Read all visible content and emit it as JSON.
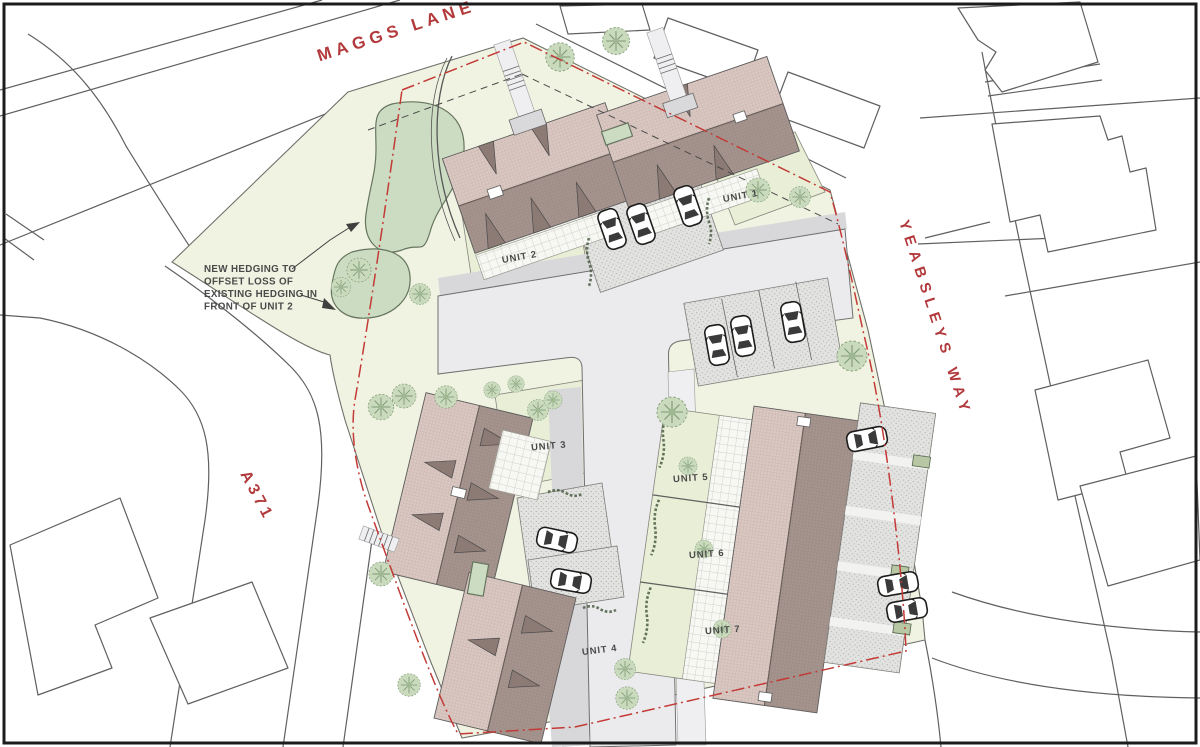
{
  "streets": {
    "maggs_lane": "MAGGS LANE",
    "yeabsleys_way": "YEABSLEYS WAY",
    "a371": "A371"
  },
  "units": [
    {
      "label": "UNIT 1"
    },
    {
      "label": "UNIT 2"
    },
    {
      "label": "UNIT 3"
    },
    {
      "label": "UNIT 4"
    },
    {
      "label": "UNIT 5"
    },
    {
      "label": "UNIT 6"
    },
    {
      "label": "UNIT 7"
    }
  ],
  "annotation": {
    "lines": [
      "NEW HEDGING TO",
      "OFFSET LOSS OF",
      "EXISTING HEDGING IN",
      "FRONT OF UNIT 2"
    ],
    "text": "NEW HEDGING TO OFFSET LOSS OF EXISTING HEDGING IN FRONT OF UNIT 2"
  },
  "colors": {
    "boundary-red": "#c33a36",
    "street-label-red": "#b23a3c",
    "site-green": "#f1f3e2",
    "garden-green": "#e8efd6",
    "tree-green": "#c9dabd",
    "hedge-green": "#ccdcc2",
    "roof-light": "#d9c7c1",
    "roof-dark": "#a5938d",
    "roof-accent": "#8c7a75",
    "road-grey": "#ebebee",
    "context-line": "#606060",
    "text-grey": "#4a4a4a"
  }
}
